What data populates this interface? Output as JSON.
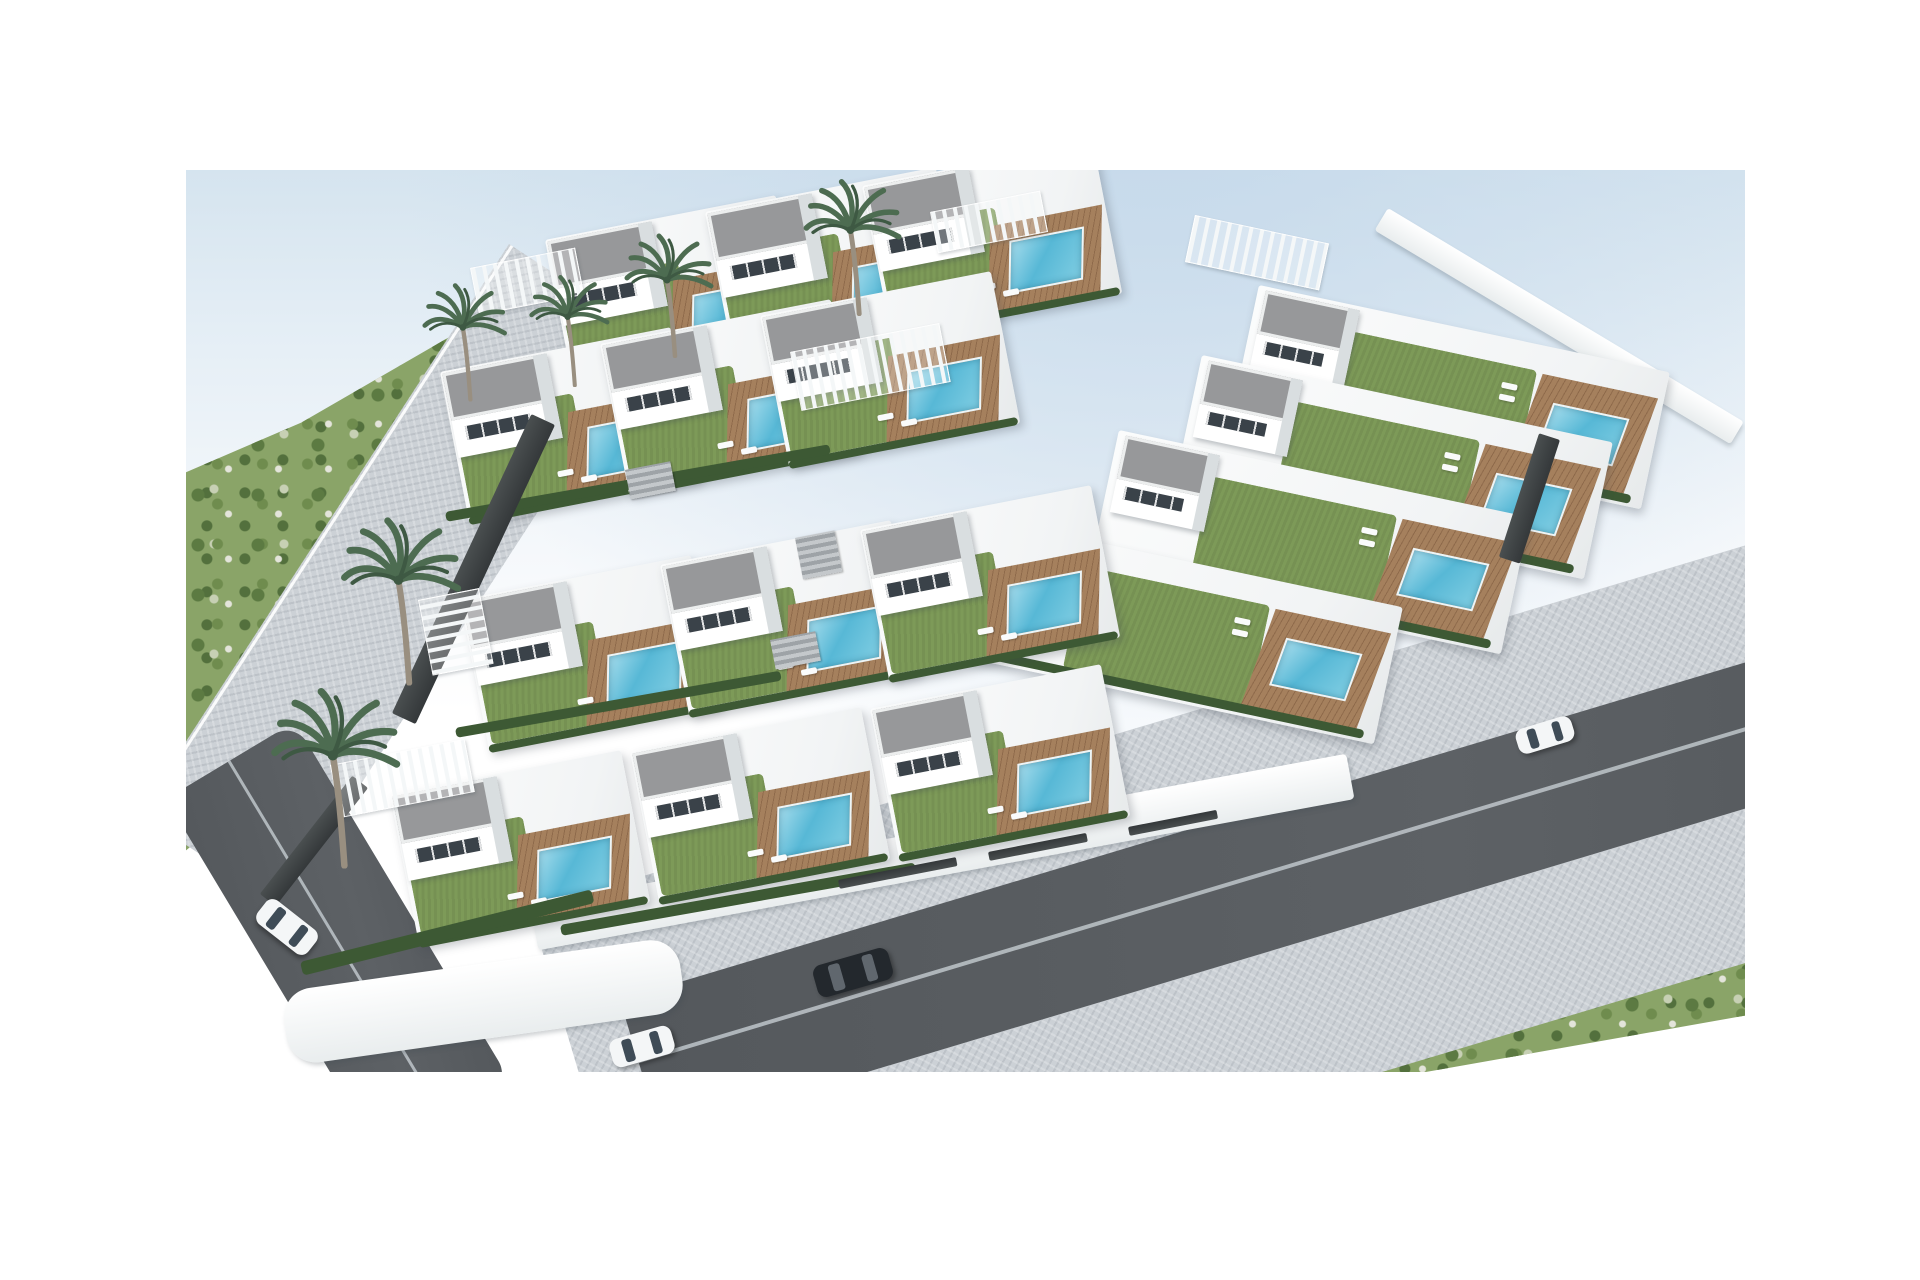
{
  "image": {
    "description": "Aerial 3D architectural rendering of a hillside residential development: rows of modern white flat-roofed villas with green lawn terraces, wooden pool decks and turquoise swimming pools, surrounded by a cobbled access road, dark asphalt streets with a few cars, palm trees and green scrubland under a pale blue sky",
    "width": 1920,
    "height": 1280,
    "visible_text": ""
  },
  "counts": {
    "villas": 16,
    "pools": 16,
    "palm_trees": 6,
    "cars": 4,
    "pergolas": 6
  },
  "colors": {
    "sky_top": "#d5e4ef",
    "sky_haze": "#c4d8ea",
    "background_white": "#ffffff",
    "wall_white": "#ffffff",
    "wall_shade": "#d9dee0",
    "roof_gray": "#97989a",
    "window_dark": "#3a4249",
    "lawn_green": "#7d9a58",
    "hedge_green": "#3d5934",
    "deck_wood": "#a5805d",
    "deck_wood_dark": "#8e6a4b",
    "pool_blue": "#57b8d6",
    "pool_light": "#a5dcec",
    "cobble_gray": "#ccd1d6",
    "asphalt_gray": "#54585c",
    "road_line": "#b2b8bd",
    "hill_green": "#8aa468",
    "hill_green_dark": "#5c7a42",
    "rock_light": "#e3e4da",
    "palm_green": "#4d6c51",
    "palm_trunk": "#998f80",
    "car_white": "#f4f6f7",
    "car_dark": "#23282d",
    "car_glass": "#3f4c57"
  },
  "scene": {
    "frame": {
      "x": 186,
      "y": 170,
      "w": 1559,
      "h": 902
    },
    "hills": {
      "left": {
        "x": 186,
        "y": 280,
        "w": 480,
        "h": 620,
        "clip": "polygon(0% 31%,24% 23%,62% 6%,83% 0%,92% 10%,46% 52%,16% 82%,0% 92%)"
      },
      "bottom_right": {
        "x": 1080,
        "y": 790,
        "w": 665,
        "h": 282,
        "clip": "polygon(2% 100%,96% 3%,100% 10%,100% 80%,52% 100%)"
      }
    },
    "roads": {
      "cobble_left": {
        "x": 509,
        "y": 244,
        "w": 170,
        "h": 680,
        "rot": 33
      },
      "asphalt_left": {
        "x": 166,
        "y": 799,
        "w": 150,
        "h": 420,
        "rot": -31
      },
      "cobble_bottom": {
        "x": 530,
        "y": 910,
        "w": 1500,
        "h": 400,
        "rot": -16.7
      },
      "asphalt_bottom": {
        "x": 620,
        "y": 1000,
        "w": 1400,
        "h": 140,
        "rot": -16.7
      }
    },
    "white_walls": [
      {
        "x": 530,
        "y": 905,
        "w": 830,
        "h": 46,
        "rot": -10.5,
        "r": 4
      },
      {
        "x": 1388,
        "y": 208,
        "w": 415,
        "h": 26,
        "rot": 31,
        "r": 3
      },
      {
        "x": 280,
        "y": 992,
        "w": 400,
        "h": 75,
        "rot": -8,
        "r": 30
      }
    ],
    "villas": [
      {
        "x": 545,
        "y": 240,
        "rot": -11,
        "variant": "std"
      },
      {
        "x": 705,
        "y": 212,
        "rot": -11,
        "variant": "std"
      },
      {
        "x": 862,
        "y": 186,
        "rot": -11,
        "variant": "std"
      },
      {
        "x": 440,
        "y": 372,
        "rot": -11,
        "variant": "std"
      },
      {
        "x": 600,
        "y": 344,
        "rot": -11,
        "variant": "std"
      },
      {
        "x": 760,
        "y": 316,
        "rot": -11,
        "variant": "std"
      },
      {
        "x": 460,
        "y": 600,
        "rot": -11,
        "variant": "std"
      },
      {
        "x": 660,
        "y": 565,
        "rot": -11,
        "variant": "std"
      },
      {
        "x": 860,
        "y": 530,
        "rot": -11,
        "variant": "std"
      },
      {
        "x": 390,
        "y": 795,
        "rot": -11,
        "variant": "std"
      },
      {
        "x": 630,
        "y": 752,
        "rot": -11,
        "variant": "std"
      },
      {
        "x": 870,
        "y": 709,
        "rot": -11,
        "variant": "std"
      },
      {
        "x": 1259,
        "y": 285,
        "rot": 12,
        "variant": "right"
      },
      {
        "x": 1202,
        "y": 355,
        "rot": 12,
        "variant": "right"
      },
      {
        "x": 1119,
        "y": 430,
        "rot": 12,
        "variant": "right"
      },
      {
        "x": 992,
        "y": 520,
        "rot": 12,
        "variant": "right"
      }
    ],
    "hedges": [
      {
        "x": 445,
        "y": 512,
        "w": 390,
        "h": 10,
        "rot": -10
      },
      {
        "x": 455,
        "y": 728,
        "w": 330,
        "h": 10,
        "rot": -10
      },
      {
        "x": 560,
        "y": 925,
        "w": 360,
        "h": 11,
        "rot": -10
      },
      {
        "x": 300,
        "y": 962,
        "w": 300,
        "h": 14,
        "rot": -14
      }
    ],
    "dark_walls": [
      {
        "x": 555,
        "y": 425,
        "w": 330,
        "h": 26,
        "rot": 115
      },
      {
        "x": 368,
        "y": 788,
        "w": 150,
        "h": 20,
        "rot": 128
      },
      {
        "x": 1560,
        "y": 440,
        "w": 130,
        "h": 22,
        "rot": 108
      },
      {
        "x": 838,
        "y": 880,
        "w": 120,
        "h": 9,
        "rot": -11
      },
      {
        "x": 988,
        "y": 852,
        "w": 100,
        "h": 9,
        "rot": -11
      },
      {
        "x": 1128,
        "y": 827,
        "w": 90,
        "h": 9,
        "rot": -11
      }
    ],
    "pergolas": [
      {
        "x": 470,
        "y": 268,
        "w": 105,
        "h": 46,
        "rot": -11,
        "dir": "h"
      },
      {
        "x": 790,
        "y": 352,
        "w": 150,
        "h": 58,
        "rot": -11,
        "dir": "h"
      },
      {
        "x": 418,
        "y": 600,
        "w": 60,
        "h": 75,
        "rot": -11,
        "dir": "v"
      },
      {
        "x": 330,
        "y": 765,
        "w": 135,
        "h": 52,
        "rot": -11,
        "dir": "h"
      },
      {
        "x": 1195,
        "y": 215,
        "w": 135,
        "h": 46,
        "rot": 12,
        "dir": "h"
      },
      {
        "x": 930,
        "y": 212,
        "w": 110,
        "h": 40,
        "rot": -11,
        "dir": "h"
      }
    ],
    "stairs": [
      {
        "x": 625,
        "y": 470,
        "w": 46,
        "h": 30,
        "rot": -11
      },
      {
        "x": 795,
        "y": 538,
        "w": 40,
        "h": 42,
        "rot": -11
      },
      {
        "x": 770,
        "y": 640,
        "w": 46,
        "h": 30,
        "rot": -11
      }
    ],
    "palms": [
      {
        "x": 463,
        "y": 327,
        "s": 0.95
      },
      {
        "x": 568,
        "y": 317,
        "s": 0.9
      },
      {
        "x": 667,
        "y": 280,
        "s": 1.0
      },
      {
        "x": 850,
        "y": 230,
        "s": 1.1
      },
      {
        "x": 398,
        "y": 580,
        "s": 1.35
      },
      {
        "x": 333,
        "y": 755,
        "s": 1.45
      }
    ],
    "cars": [
      {
        "x": 255,
        "y": 912,
        "w": 64,
        "h": 30,
        "rot": 38,
        "color": "white"
      },
      {
        "x": 814,
        "y": 956,
        "w": 78,
        "h": 33,
        "rot": -16,
        "color": "dark"
      },
      {
        "x": 1516,
        "y": 722,
        "w": 58,
        "h": 26,
        "rot": -17,
        "color": "white"
      },
      {
        "x": 610,
        "y": 1032,
        "w": 64,
        "h": 29,
        "rot": -16,
        "color": "white"
      }
    ]
  }
}
